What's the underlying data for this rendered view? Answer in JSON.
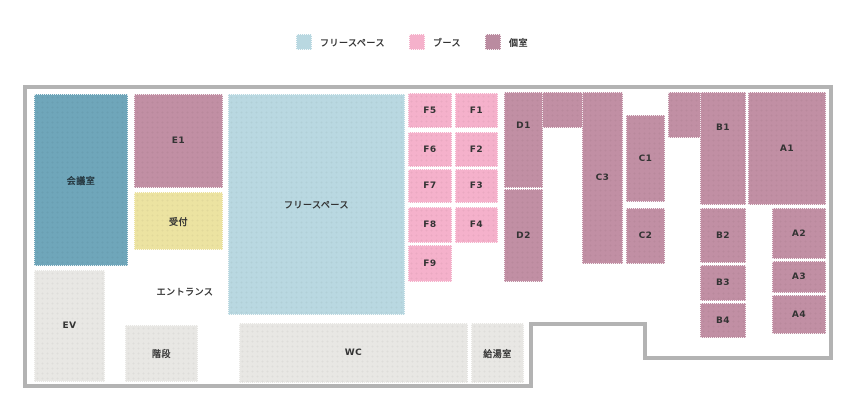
{
  "legend": {
    "items": [
      {
        "label": "フリースペース",
        "color": "#b9d8e1"
      },
      {
        "label": "ブース",
        "color": "#f5b1cb"
      },
      {
        "label": "個室",
        "color": "#ba8ba0"
      }
    ]
  },
  "floorplan": {
    "rooms": {
      "meeting": "会議室",
      "e1": "E1",
      "reception": "受付",
      "free_space": "フリースペース",
      "f5": "F5",
      "f1": "F1",
      "f6": "F6",
      "f2": "F2",
      "f7": "F7",
      "f3": "F3",
      "f8": "F8",
      "f4": "F4",
      "f9": "F9",
      "d1": "D1",
      "d2": "D2",
      "c3": "C3",
      "c1": "C1",
      "c2": "C2",
      "b1": "B1",
      "b2": "B2",
      "b3": "B3",
      "b4": "B4",
      "a1": "A1",
      "a2": "A2",
      "a3": "A3",
      "a4": "A4",
      "entrance": "エントランス",
      "ev": "EV",
      "stairs": "階段",
      "wc": "WC",
      "kitchenette": "給湯室"
    },
    "colors": {
      "free_space": "#b9d8e1",
      "booth": "#f5b1cb",
      "private_room": "#c18fa4",
      "meeting_room": "#6fa6ba",
      "reception": "#ece3a1",
      "facility": "#e8e7e4",
      "wall": "#b3b3b3",
      "background": "#ffffff"
    }
  }
}
